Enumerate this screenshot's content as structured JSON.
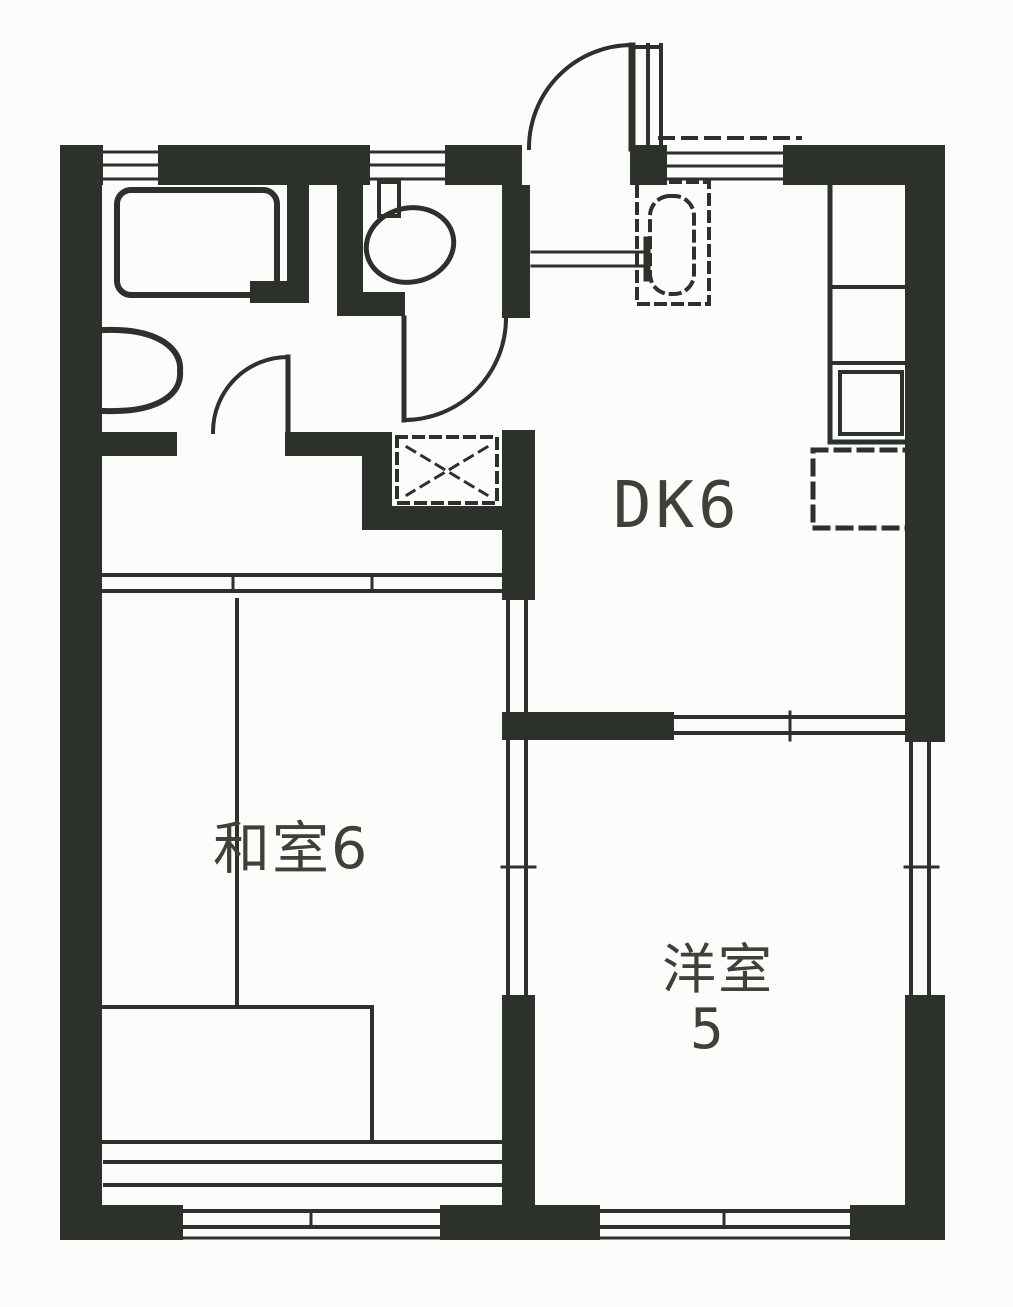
{
  "plan": {
    "rooms": {
      "dk": {
        "label": "DK6"
      },
      "japanese_room": {
        "label": "和室6"
      },
      "western_room": {
        "label_line1": "洋室",
        "label_line2": "5"
      }
    },
    "fixtures": [
      "bathtub",
      "washbasin",
      "toilet",
      "kitchen-counter",
      "stove",
      "refrigerator-space",
      "water-heater-space",
      "washing-machine-space",
      "entrance-door",
      "interior-doors",
      "sliding-doors",
      "windows",
      "tatami-divisions"
    ],
    "colors": {
      "ink": "#2c312b",
      "ink_text": "#3c413a",
      "paper": "#fcfcfa"
    }
  }
}
